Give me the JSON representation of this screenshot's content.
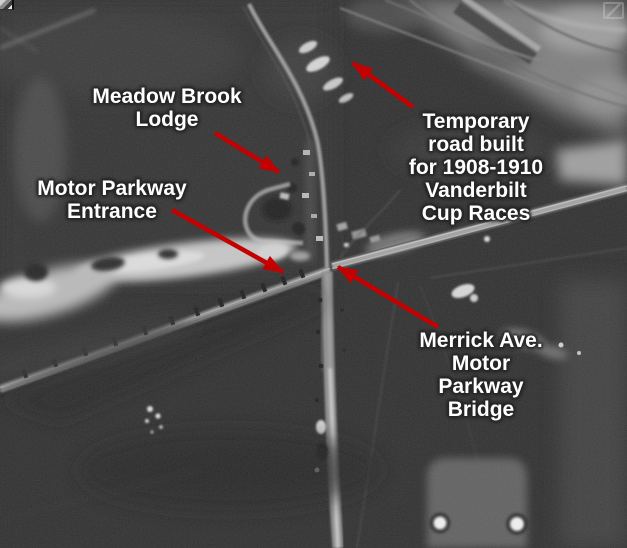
{
  "figure": {
    "description": "Annotated black-and-white aerial photograph of the Long Island Motor Parkway at Merrick Avenue",
    "annotations": [
      {
        "id": "meadow-brook-lodge",
        "text": "Meadow Brook\nLodge"
      },
      {
        "id": "motor-parkway-entrance",
        "text": "Motor Parkway\nEntrance"
      },
      {
        "id": "temporary-road",
        "text": "Temporary road built\nfor 1908-1910 Vanderbilt\nCup Races"
      },
      {
        "id": "merrick-ave-bridge",
        "text": "Merrick Ave.\nMotor Parkway Bridge"
      }
    ],
    "style": {
      "arrow_color": "#c40000",
      "label_color": "#ffffff",
      "label_outline": "#2a2a2a",
      "photo_base_tone": "#262626"
    },
    "icons": [
      {
        "name": "image-artifact-icon",
        "position": "top-left"
      },
      {
        "name": "zoom-overlay-icon",
        "position": "top-right"
      }
    ]
  }
}
